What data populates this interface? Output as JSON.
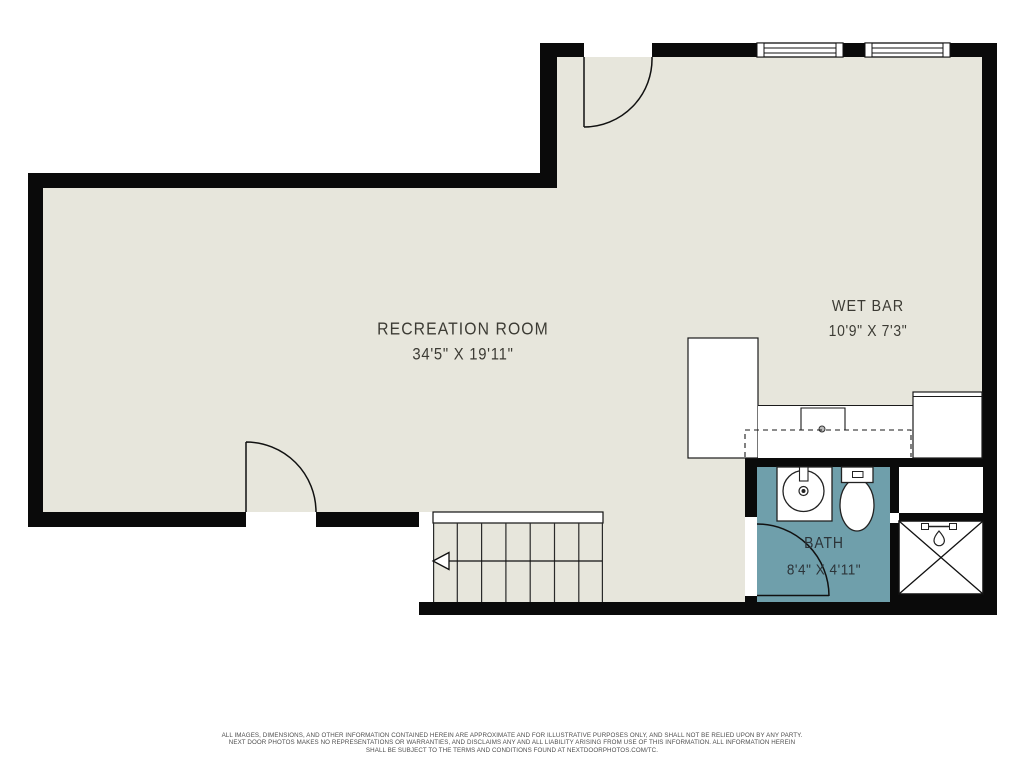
{
  "floor_plan": {
    "rooms": [
      {
        "name": "RECREATION ROOM",
        "dimensions": "34'5\" X 19'11\""
      },
      {
        "name": "WET BAR",
        "dimensions": "10'9\" X 7'3\""
      },
      {
        "name": "BATH",
        "dimensions": "8'4\" X 4'11\""
      }
    ],
    "colors": {
      "background": "#ffffff",
      "wall": "#0a0a0a",
      "floor": "#e7e6dc",
      "bath_floor": "#6f9fab",
      "line": "#1a1a1a"
    },
    "fixtures": [
      "stairs",
      "stair-direction-arrow",
      "shower",
      "shower-head",
      "toilet",
      "vanity-sink",
      "wet-bar-sink",
      "wet-bar-counter",
      "cabinet",
      "window",
      "door-swing"
    ],
    "disclaimer": {
      "line1": "ALL IMAGES, DIMENSIONS, AND OTHER INFORMATION CONTAINED HEREIN ARE APPROXIMATE AND FOR ILLUSTRATIVE PURPOSES ONLY, AND SHALL NOT BE RELIED UPON BY ANY PARTY.",
      "line2": "NEXT DOOR PHOTOS MAKES NO REPRESENTATIONS OR WARRANTIES, AND DISCLAIMS ANY AND ALL LIABILITY ARISING FROM USE OF THIS INFORMATION. ALL INFORMATION HEREIN",
      "line3": "SHALL BE SUBJECT TO THE TERMS AND CONDITIONS FOUND AT NEXTDOORPHOTOS.COM/TC."
    }
  }
}
